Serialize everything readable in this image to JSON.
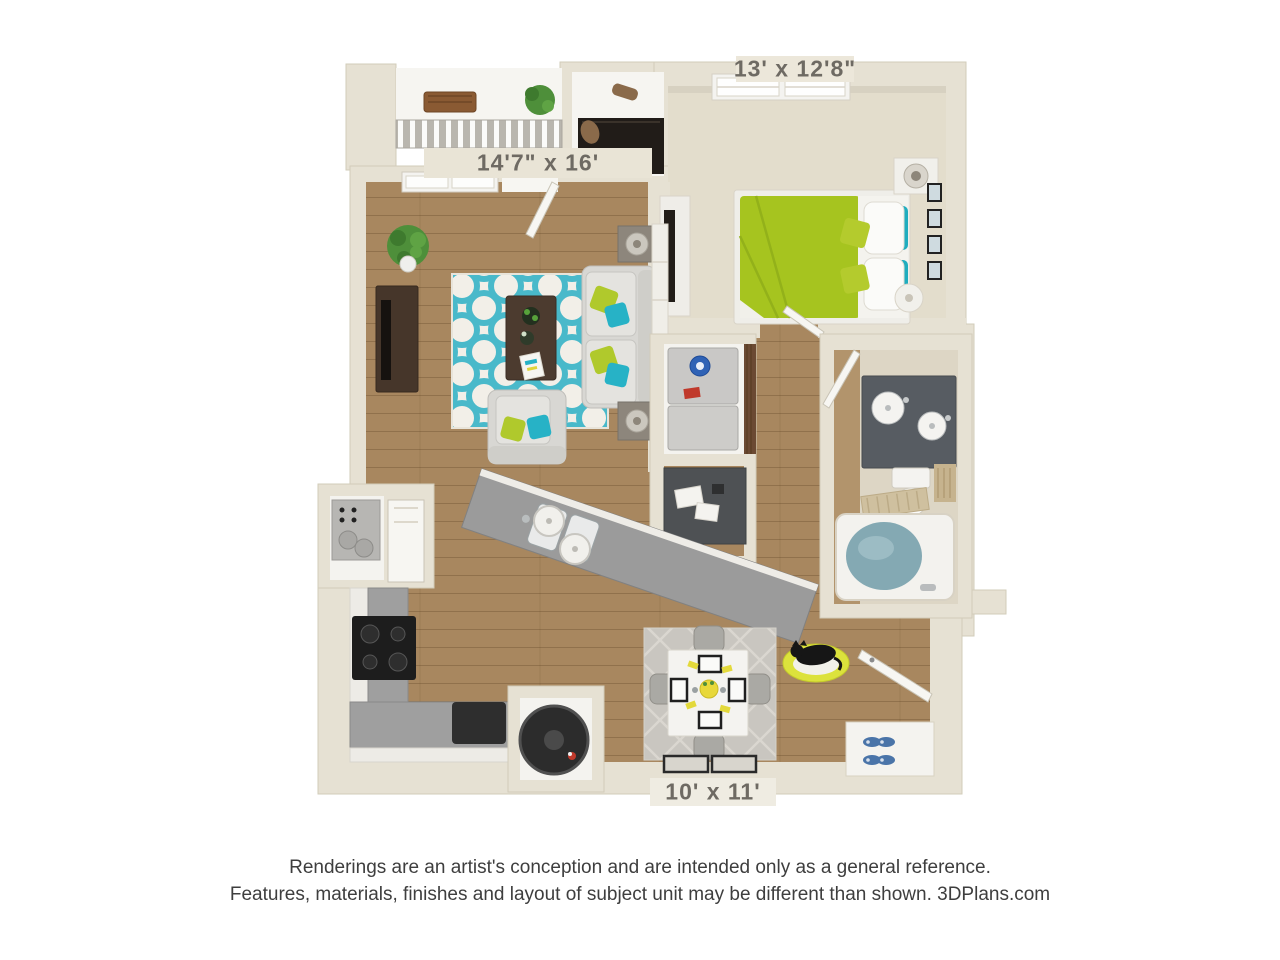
{
  "plan": {
    "type": "3d-floorplan-rendering",
    "dimensions": {
      "bedroom": "13' x 12'8\"",
      "living_room": "14'7\" x 16'",
      "dining": "10' x 11'"
    },
    "rooms": [
      "balcony",
      "walk-in-closet",
      "bedroom",
      "living-room",
      "laundry-closet",
      "desk-nook",
      "bathroom",
      "kitchen",
      "utility-closet",
      "dining-area",
      "entry"
    ],
    "palette": {
      "wall_beige": "#e6e1d3",
      "wall_edge": "#d2ccba",
      "wood_floor": "#a8875f",
      "carpet": "#e3ddcc",
      "white_floor": "#f6f5f1",
      "accent_lime": "#a6c41f",
      "accent_teal": "#27b2c6",
      "rug_teal": "#49b9ca",
      "accent_yellow": "#dce23c",
      "counter_gray": "#9f9f9f",
      "stove_black": "#1d1d1d",
      "vanity_gray": "#575c62",
      "tub_water": "#84a9b3",
      "dark_wood": "#46362a",
      "label_text": "#6e6a63",
      "disclaimer_text": "#3e3e3e"
    }
  },
  "disclaimer": {
    "line1": "Renderings are an artist's conception and are intended only as a general reference.",
    "line2": "Features, materials, finishes and layout of subject unit may be different than shown. 3DPlans.com"
  }
}
